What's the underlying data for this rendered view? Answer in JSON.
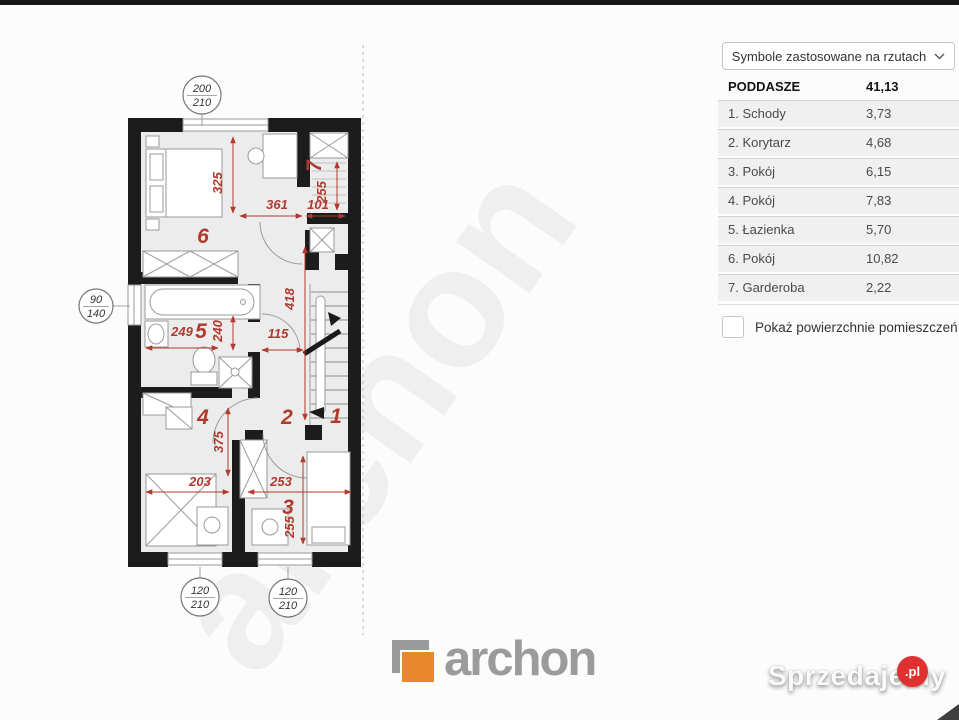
{
  "sidebar": {
    "dropdown_label": "Symbole zastosowane na rzutach",
    "header": {
      "label": "PODDASZE",
      "value": "41,13"
    },
    "rows": [
      {
        "label": "1. Schody",
        "value": "3,73"
      },
      {
        "label": "2. Korytarz",
        "value": "4,68"
      },
      {
        "label": "3. Pokój",
        "value": "6,15"
      },
      {
        "label": "4. Pokój",
        "value": "7,83"
      },
      {
        "label": "5. Łazienka",
        "value": "5,70"
      },
      {
        "label": "6. Pokój",
        "value": "10,82"
      },
      {
        "label": "7. Garderoba",
        "value": "2,22"
      }
    ],
    "checkbox_label": "Pokaż powierzchnie pomieszczeń",
    "checkbox_checked": false
  },
  "plan": {
    "red": "#b03a2e",
    "watermark": "archon",
    "room_numbers": {
      "r1": "1",
      "r2": "2",
      "r3": "3",
      "r4": "4",
      "r5": "5",
      "r6": "6",
      "r7": "7"
    },
    "dims": [
      "325",
      "361",
      "101",
      "255",
      "418",
      "249",
      "240",
      "115",
      "375",
      "203",
      "253",
      "255"
    ],
    "windows": [
      {
        "w": "200",
        "h": "210"
      },
      {
        "w": "90",
        "h": "140"
      },
      {
        "w": "120",
        "h": "210"
      },
      {
        "w": "120",
        "h": "210"
      }
    ]
  },
  "footer": {
    "logo_text": "archon",
    "logo_orange": "#e8872b",
    "logo_gray": "#9b9b9b"
  },
  "site_watermark": {
    "text": "Sprzedajemy",
    "tld": ".pl",
    "red": "#e03131"
  }
}
